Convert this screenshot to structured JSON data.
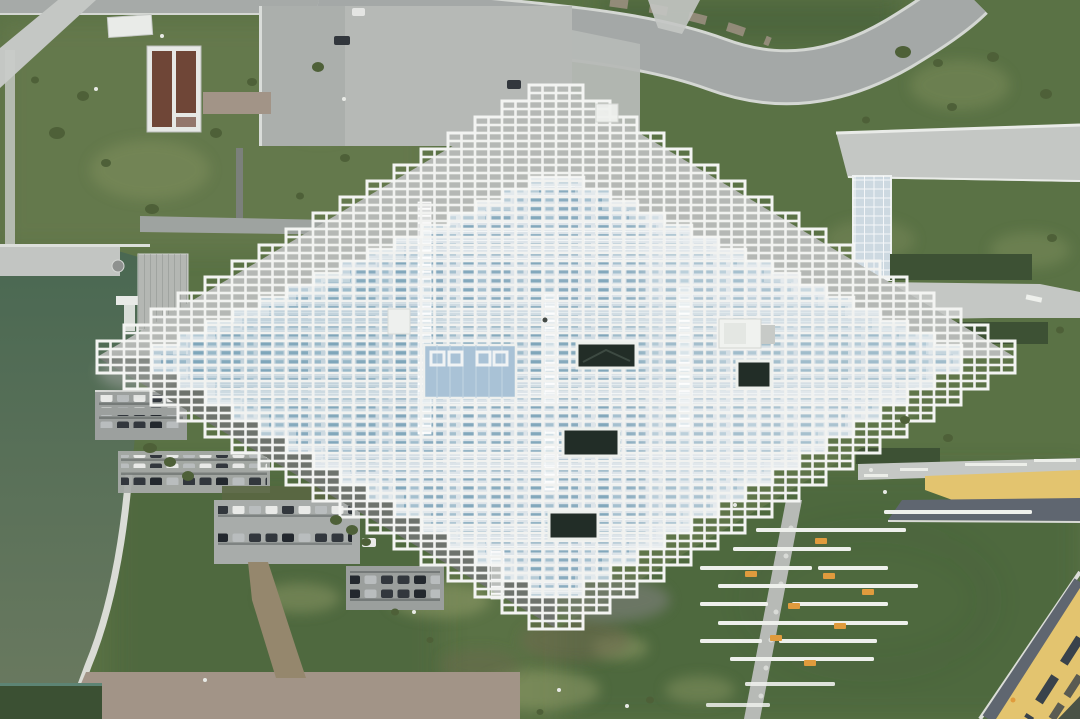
{
  "scene": {
    "type": "aerial-photograph",
    "subject": "large diamond-shaped museum building with pixelated stepped white pergola grid roof over pale blue glazed glass roof",
    "setting": "landscaped campus with lawns, curving access road, green pond with marina pier, parking lots, gravel yard, yellow promenade plaza and rows of white linear benches with orange seats",
    "features": [
      "stepped-pergola-roof",
      "glass-roof-rows",
      "roof-skylight-panel",
      "roof-vent-openings",
      "rooftop-unit",
      "curving-road",
      "north-plaza",
      "maintenance-building-roof",
      "storage-shed-roof",
      "gravel-path",
      "pond",
      "quay",
      "wood-deck",
      "white-pontoon",
      "boat-pier",
      "shoreline-path",
      "parking-rows",
      "dirt-path",
      "gravel-yard",
      "hedges",
      "planting-beds",
      "ramp",
      "blue-grid-ramp",
      "yellow-plaza-strip",
      "yellow-promenade-band",
      "asphalt-paths",
      "bench-lines",
      "orange-benches",
      "diagonal-walk"
    ],
    "counts": {
      "bench_lines": 12,
      "orange_benches": 8,
      "parking_rows": 8,
      "roof_openings": 4
    }
  },
  "palette": {
    "grass_base": "#5a7245",
    "grass_dark": "#47623b",
    "grass_light": "#78885a",
    "worn": "#96a06b",
    "road": "#a4a8a7",
    "road_edge": "#d4d7d3",
    "path_light": "#c4c7c4",
    "plaza": "#b6b9b6",
    "plaza_dark": "#abafac",
    "concrete_dark": "#6e736d",
    "asphalt_dark": "#5f6670",
    "pond_top": "#4a6852",
    "pond_bottom": "#6b7a60",
    "shoreline": "#dadcd6",
    "pergola": "#f1f2f0",
    "glass_base": "#dde4e9",
    "blue1": "#8aacbf",
    "blue2": "#a5c0cf",
    "blue3": "#83a8bc",
    "skyblue": "#a9c2d6",
    "roof_dark": "#222d27",
    "roof_white": "#f0f2ef",
    "yellow": "#e3c46f",
    "orange": "#e09b3d",
    "hedge": "#3d5134",
    "shrub": "#4e6038",
    "gravel": "#a29487",
    "dirt": "#95876d",
    "deck": "#b4b7b3",
    "brown_roof": "#6f4637",
    "car_white": "#e9eae8",
    "car_dark": "#32373d",
    "car_silver": "#b9bdbe",
    "slot_dark": "#39424b"
  }
}
